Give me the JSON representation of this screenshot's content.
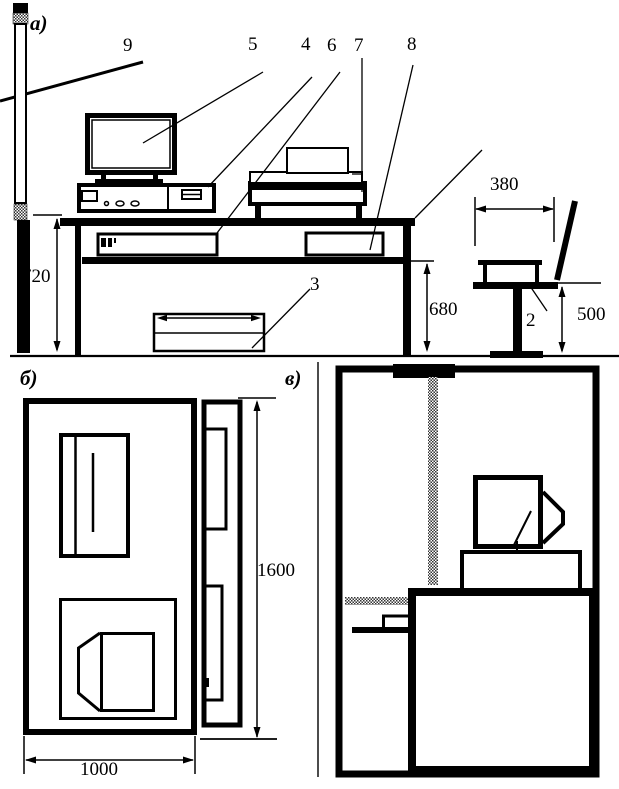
{
  "panels": {
    "a": {
      "label": "а)",
      "callouts": {
        "side_screen": "9",
        "monitor": "5",
        "system_unit": "4",
        "keyboard": "6",
        "printer": "7",
        "shelf_unit": "8",
        "footrest": "3",
        "chair": "2"
      },
      "dimensions": {
        "desk_height": "720",
        "shelf_height": "680",
        "seat_width": "380",
        "seat_height": "500"
      }
    },
    "b": {
      "label": "б)",
      "dimensions": {
        "desk_length": "1600",
        "desk_width": "1000"
      }
    },
    "v": {
      "label": "в)"
    }
  },
  "colors": {
    "ink": "#000000",
    "paper": "#ffffff"
  }
}
